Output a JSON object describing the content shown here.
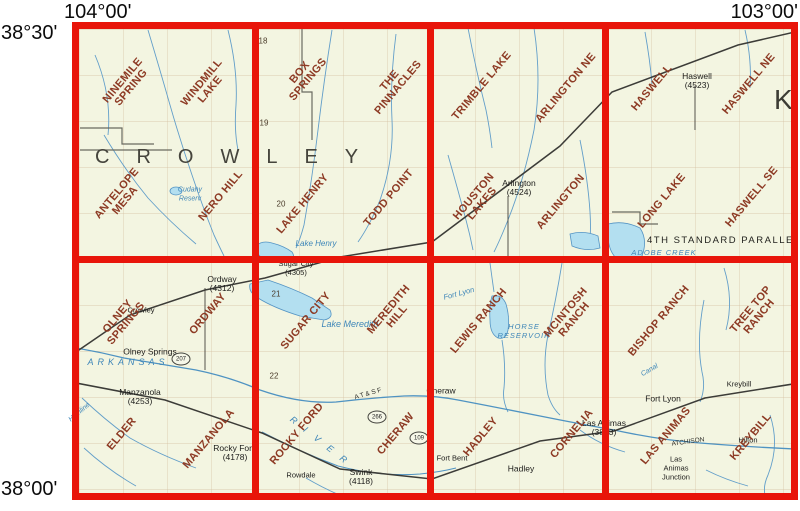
{
  "corner_labels": {
    "lon_left": "104°00'",
    "lon_right": "103°00'",
    "lat_top": "38°30'",
    "lat_bottom": "38°00'"
  },
  "counties": {
    "crowley": "CROWLEY",
    "kiowa_partial": "K"
  },
  "parallel_label": "4TH STANDARD PARALLEL",
  "colors": {
    "grid_red": "#e8150a",
    "quad_text": "#8d3a24",
    "map_background": "#f3f5e1",
    "water_line": "#5b9ac8",
    "water_fill": "#b3dff0",
    "black_text": "#1c1c1a"
  },
  "quads": [
    {
      "name": "ninemile-spring",
      "label": "NINEMILE\nSPRING"
    },
    {
      "name": "windmill-lake",
      "label": "WINDMILL\nLAKE"
    },
    {
      "name": "box-springs",
      "label": "BOX\nSPRINGS"
    },
    {
      "name": "the-pinnacles",
      "label": "THE\nPINNACLES"
    },
    {
      "name": "trimble-lake",
      "label": "TRIMBLE LAKE"
    },
    {
      "name": "arlington-ne",
      "label": "ARLINGTON NE"
    },
    {
      "name": "haswell",
      "label": "HASWELL"
    },
    {
      "name": "haswell-ne",
      "label": "HASWELL NE"
    },
    {
      "name": "antelope-mesa",
      "label": "ANTELOPE\nMESA"
    },
    {
      "name": "nero-hill",
      "label": "NERO HILL"
    },
    {
      "name": "lake-henry",
      "label": "LAKE HENRY"
    },
    {
      "name": "todd-point",
      "label": "TODD POINT"
    },
    {
      "name": "houston-lakes",
      "label": "HOUSTON\nLAKES"
    },
    {
      "name": "arlington",
      "label": "ARLINGTON"
    },
    {
      "name": "long-lake",
      "label": "LONG LAKE"
    },
    {
      "name": "haswell-se",
      "label": "HASWELL SE"
    },
    {
      "name": "olney-springs",
      "label": "OLNEY\nSPRINGS"
    },
    {
      "name": "ordway",
      "label": "ORDWAY"
    },
    {
      "name": "sugar-city",
      "label": "SUGAR CITY"
    },
    {
      "name": "meredith-hill",
      "label": "MEREDITH\nHILL"
    },
    {
      "name": "lewis-ranch",
      "label": "LEWIS RANCH"
    },
    {
      "name": "mcintosh-ranch",
      "label": "MCINTOSH\nRANCH"
    },
    {
      "name": "bishop-ranch",
      "label": "BISHOP RANCH"
    },
    {
      "name": "tree-top-ranch",
      "label": "TREE TOP\nRANCH"
    },
    {
      "name": "elder",
      "label": "ELDER"
    },
    {
      "name": "manzanola",
      "label": "MANZANOLA"
    },
    {
      "name": "rocky-ford",
      "label": "ROCKY FORD"
    },
    {
      "name": "cheraw",
      "label": "CHERAW"
    },
    {
      "name": "hadley",
      "label": "HADLEY"
    },
    {
      "name": "cornelia",
      "label": "CORNELIA"
    },
    {
      "name": "las-animas",
      "label": "LAS ANIMAS"
    },
    {
      "name": "kreybill",
      "label": "KREYBILL"
    }
  ],
  "towns": [
    {
      "name": "haswell-town",
      "label": "Haswell\n(4523)"
    },
    {
      "name": "arlington-town",
      "label": "Arlington\n(4524)"
    },
    {
      "name": "ordway-town",
      "label": "Ordway\n(4312)"
    },
    {
      "name": "crowley-town",
      "label": "Crowley"
    },
    {
      "name": "olney-springs-town",
      "label": "Olney Springs"
    },
    {
      "name": "sugar-city-town",
      "label": "Sugar City\n(4305)"
    },
    {
      "name": "manzanola-town",
      "label": "Manzanola\n(4253)"
    },
    {
      "name": "rocky-ford-town",
      "label": "Rocky Ford\n(4178)"
    },
    {
      "name": "rowdale-town",
      "label": "Rowdale"
    },
    {
      "name": "swink-town",
      "label": "Swink\n(4118)"
    },
    {
      "name": "cheraw-town",
      "label": "Cheraw"
    },
    {
      "name": "fort-bent-site",
      "label": "Fort Bent"
    },
    {
      "name": "hadley-town",
      "label": "Hadley"
    },
    {
      "name": "las-animas-town",
      "label": "Las Animas\n(3893)"
    },
    {
      "name": "fort-lyon-town",
      "label": "Fort Lyon"
    },
    {
      "name": "kreybill-town",
      "label": "Kreybill"
    },
    {
      "name": "hilton-town",
      "label": "Hilton"
    },
    {
      "name": "las-animas-junction",
      "label": "Las\nAnimas\nJunction"
    }
  ],
  "water_labels": [
    {
      "name": "arkansas-river-label",
      "label": "ARKANSAS"
    },
    {
      "name": "river-label",
      "label": "R I V E R"
    },
    {
      "name": "lake-henry-label",
      "label": "Lake Henry"
    },
    {
      "name": "lake-meredith-label",
      "label": "Lake Meredith"
    },
    {
      "name": "cudahy-reservoir-label",
      "label": "Cudahy\nReserv"
    },
    {
      "name": "adobe-creek-label",
      "label": "ADOBE CREEK"
    },
    {
      "name": "horse-reservoir-label-1",
      "label": "HORSE"
    },
    {
      "name": "horse-reservoir-label-2",
      "label": "RESERVOIR"
    },
    {
      "name": "fort-lyon-canal-label",
      "label": "Fort Lyon"
    },
    {
      "name": "highline-canal-label",
      "label": "Highline"
    },
    {
      "name": "canal-label",
      "label": "Canal"
    }
  ],
  "section_numbers": [
    {
      "label": "18"
    },
    {
      "label": "19"
    },
    {
      "label": "20"
    },
    {
      "label": "21"
    },
    {
      "label": "22"
    }
  ],
  "highway_shields": [
    {
      "label": "207"
    },
    {
      "label": "266"
    },
    {
      "label": "109"
    }
  ],
  "railroad_labels": [
    {
      "label": "A T & S F"
    },
    {
      "label": "ATCHISON"
    }
  ]
}
